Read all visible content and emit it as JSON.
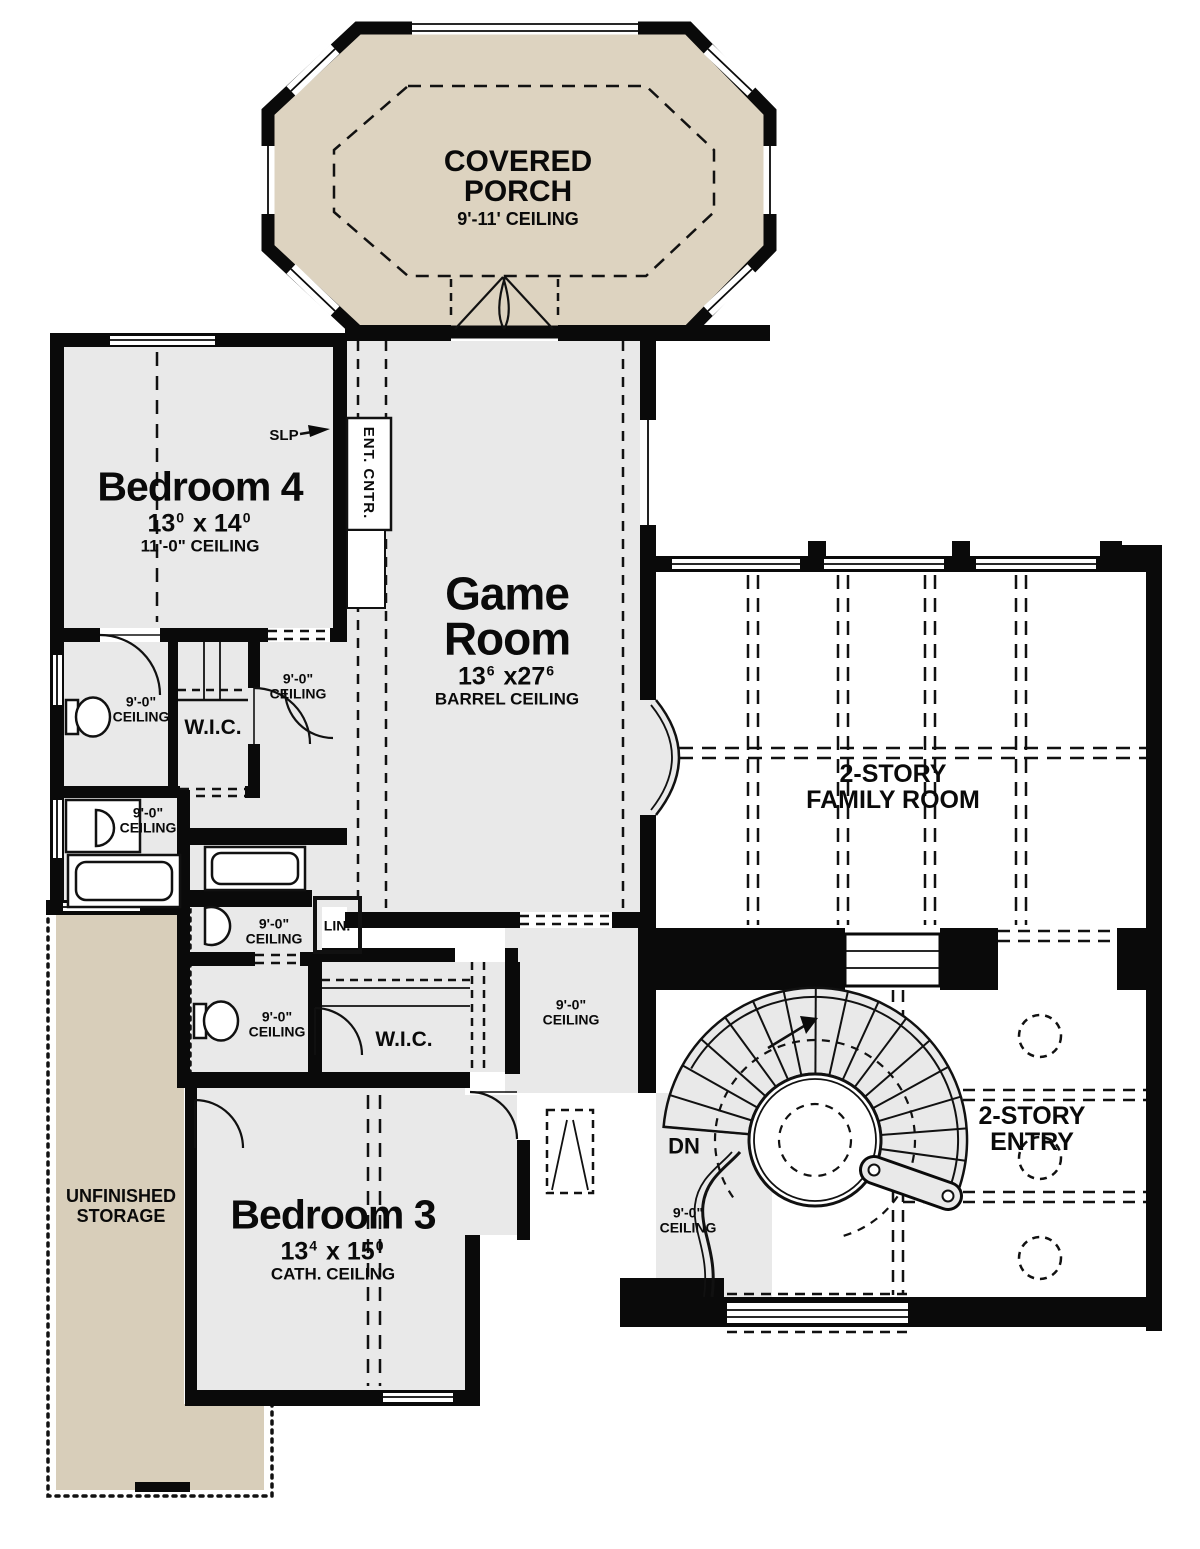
{
  "colors": {
    "wall": "#0a0a0a",
    "room_fill": "#e9e9e9",
    "porch_fill": "#ddd3c0",
    "storage_fill": "#d8ceba",
    "line": "#111111",
    "background": "#ffffff"
  },
  "rooms": {
    "covered_porch": {
      "line1": "COVERED",
      "line2": "PORCH",
      "ceiling": "9'-11' CEILING"
    },
    "bedroom4": {
      "name": "Bedroom 4",
      "dim_a": "13",
      "dim_a_sup": "0",
      "dim_sep": "x",
      "dim_b": "14",
      "dim_b_sup": "0",
      "ceiling": "11'-0\" CEILING"
    },
    "game_room": {
      "line1": "Game",
      "line2": "Room",
      "dim_a": "13",
      "dim_a_sup": "6",
      "dim_sep": "x",
      "dim_b": "27",
      "dim_b_sup": "6",
      "ceiling": "BARREL CEILING"
    },
    "family_room": {
      "line1": "2-STORY",
      "line2": "FAMILY ROOM"
    },
    "entry": {
      "line1": "2-STORY",
      "line2": "ENTRY"
    },
    "bedroom3": {
      "name": "Bedroom 3",
      "dim_a": "13",
      "dim_a_sup": "4",
      "dim_sep": "x",
      "dim_b": "15",
      "dim_b_sup": "0",
      "ceiling": "CATH. CEILING"
    },
    "storage": {
      "line1": "UNFINISHED",
      "line2": "STORAGE"
    }
  },
  "labels": {
    "wic": "W.I.C.",
    "linen": "LIN.",
    "down": "DN",
    "slope": "SLP",
    "ent_center": "ENT. CNTR.",
    "ceiling9_line1": "9'-0\"",
    "ceiling9_line2": "CEILING"
  }
}
